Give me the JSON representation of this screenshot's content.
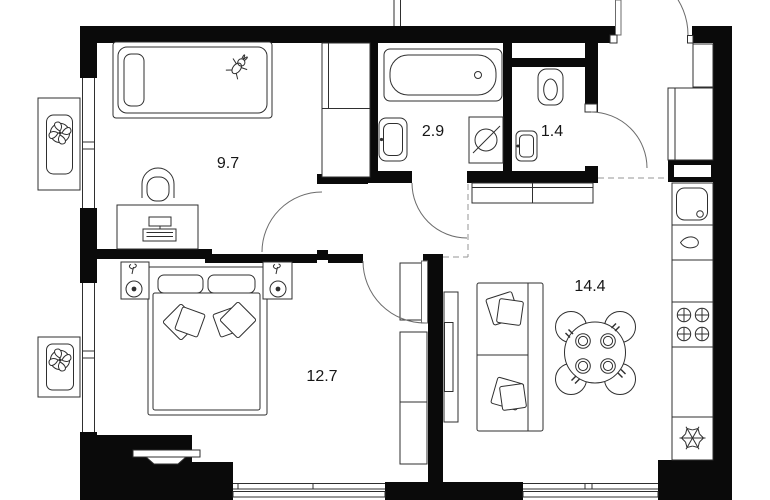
{
  "colors": {
    "wall": "#0a0a0a",
    "line": "#2f2f2f",
    "door": "#6b6b6b",
    "dash": "#949494",
    "label": "#161616",
    "bg": "#ffffff"
  },
  "rooms": [
    {
      "id": "kids-room",
      "area_label": "9.7"
    },
    {
      "id": "bathroom",
      "area_label": "2.9"
    },
    {
      "id": "toilet",
      "area_label": "1.4"
    },
    {
      "id": "bedroom",
      "area_label": "12.7"
    },
    {
      "id": "kitchen-living-room",
      "area_label": "14.4"
    }
  ],
  "icons": {
    "ac_unit": "four-blade-fan",
    "washing_machine": "drum-circle-with-slash",
    "stove": "four-burner-hob-crosses",
    "fridge": "snowflake",
    "windows": "double-parallel-lines",
    "doors": "quarter-circle-swing-arc"
  }
}
